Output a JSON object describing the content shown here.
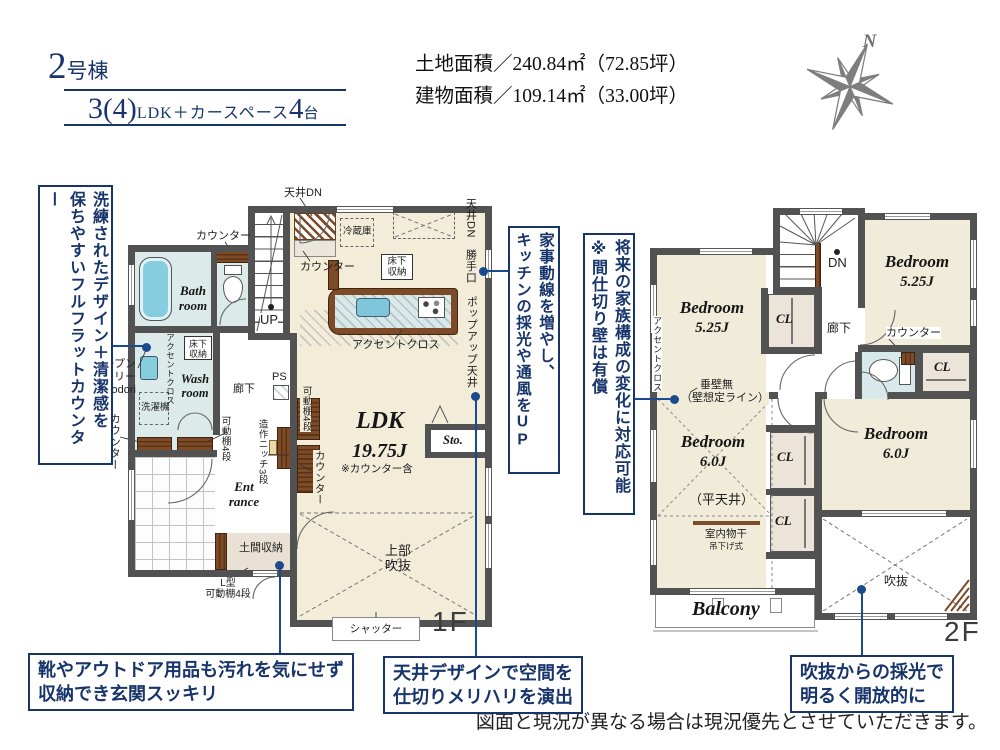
{
  "palette": {
    "navy": "#17356b",
    "callout_blue": "#1b4a8e",
    "wall": "#525252",
    "cream": "#f2ecd9",
    "wet_blue": "#dcebe9",
    "wood": "#7d4b27",
    "tub_blue": "#86cde0"
  },
  "header": {
    "bldg_num": "2",
    "bldg_suffix": "号棟",
    "plan": {
      "num": "3",
      "paren": "(4)",
      "ldk": "LDK＋カースペース",
      "cars": "4",
      "cars_unit": "台"
    },
    "land_area": "土地面積／240.84㎡（72.85坪）",
    "bldg_area": "建物面積／109.14㎡（33.00坪）"
  },
  "compass": {
    "n": "N"
  },
  "notes": {
    "flat_counter": {
      "col1": "洗練されたデザイン＋清潔感を",
      "col2": "保ちやすいフルフラットカウンター"
    },
    "open_sanitary": {
      "l1": "オープン",
      "l2": "サニタリー",
      "l3": "irodori"
    },
    "kaji": {
      "col1": "家事動線を増やし、",
      "col2a": "キッチンの採光や通風を",
      "col2b": "UP"
    },
    "future": {
      "col1": "将来の家族構成の変化に対応可能",
      "col2": "※間仕切り壁は有償"
    },
    "genkan": {
      "l1": "靴やアウトドア用品も汚れを気にせず",
      "l2": "収納でき玄関スッキリ"
    },
    "tenjo": {
      "l1": "天井デザインで空間を",
      "l2": "仕切りメリハリを演出"
    },
    "fukinuke": {
      "l1": "吹抜からの採光で",
      "l2": "明るく開放的に"
    }
  },
  "disclaimer": "図面と現況が異なる場合は現況優先とさせていただきます。",
  "f1": {
    "tag": "1F",
    "labels": {
      "tenjo_dn_a": "天井DN",
      "counter_a": "カウンター",
      "reizoko": "冷蔵庫",
      "yukashita_a": "床下収納",
      "counter_b": "カウンター",
      "accent_a": "アクセントクロス",
      "tenjo_dn_b": "天井DN",
      "katteguchi": "勝手口",
      "popup": "ポップアップ天井",
      "bath_a": "Bath",
      "bath_b": "room",
      "wash_a": "Wash",
      "wash_b": "room",
      "yukashita_b": "床下収納",
      "accent_b": "アクセントクロス",
      "sentakuki": "洗濯機",
      "counter_c": "カウンター",
      "kado_a": "可動棚4段",
      "rouka": "廊下",
      "ps": "PS",
      "kado_b": "可動棚4段",
      "niche": "造作ニッチ3段",
      "counter_d": "カウンター",
      "ldk": "LDK",
      "ldk_size": "19.75J",
      "ldk_note": "※カウンター含",
      "sto": "Sto.",
      "up": "UP",
      "ent_a": "Ent",
      "ent_b": "rance",
      "doma": "土間収納",
      "lg_a": "L型",
      "lg_b": "可動棚4段",
      "jobu_a": "上部",
      "jobu_b": "吹抜",
      "shutter": "シャッター"
    }
  },
  "f2": {
    "tag": "2F",
    "labels": {
      "dn": "DN",
      "bedroom": "Bedroom",
      "s525": "5.25J",
      "s60": "6.0J",
      "cl": "CL",
      "rouka": "廊下",
      "counter": "カウンター",
      "accent": "アクセントクロス",
      "tare_a": "垂壁無",
      "tare_b": "（壁想定ライン）",
      "hira": "（平天井）",
      "mono_a": "室内物干",
      "mono_b": "吊下げ式",
      "balcony": "Balcony",
      "fuki": "吹抜"
    }
  }
}
